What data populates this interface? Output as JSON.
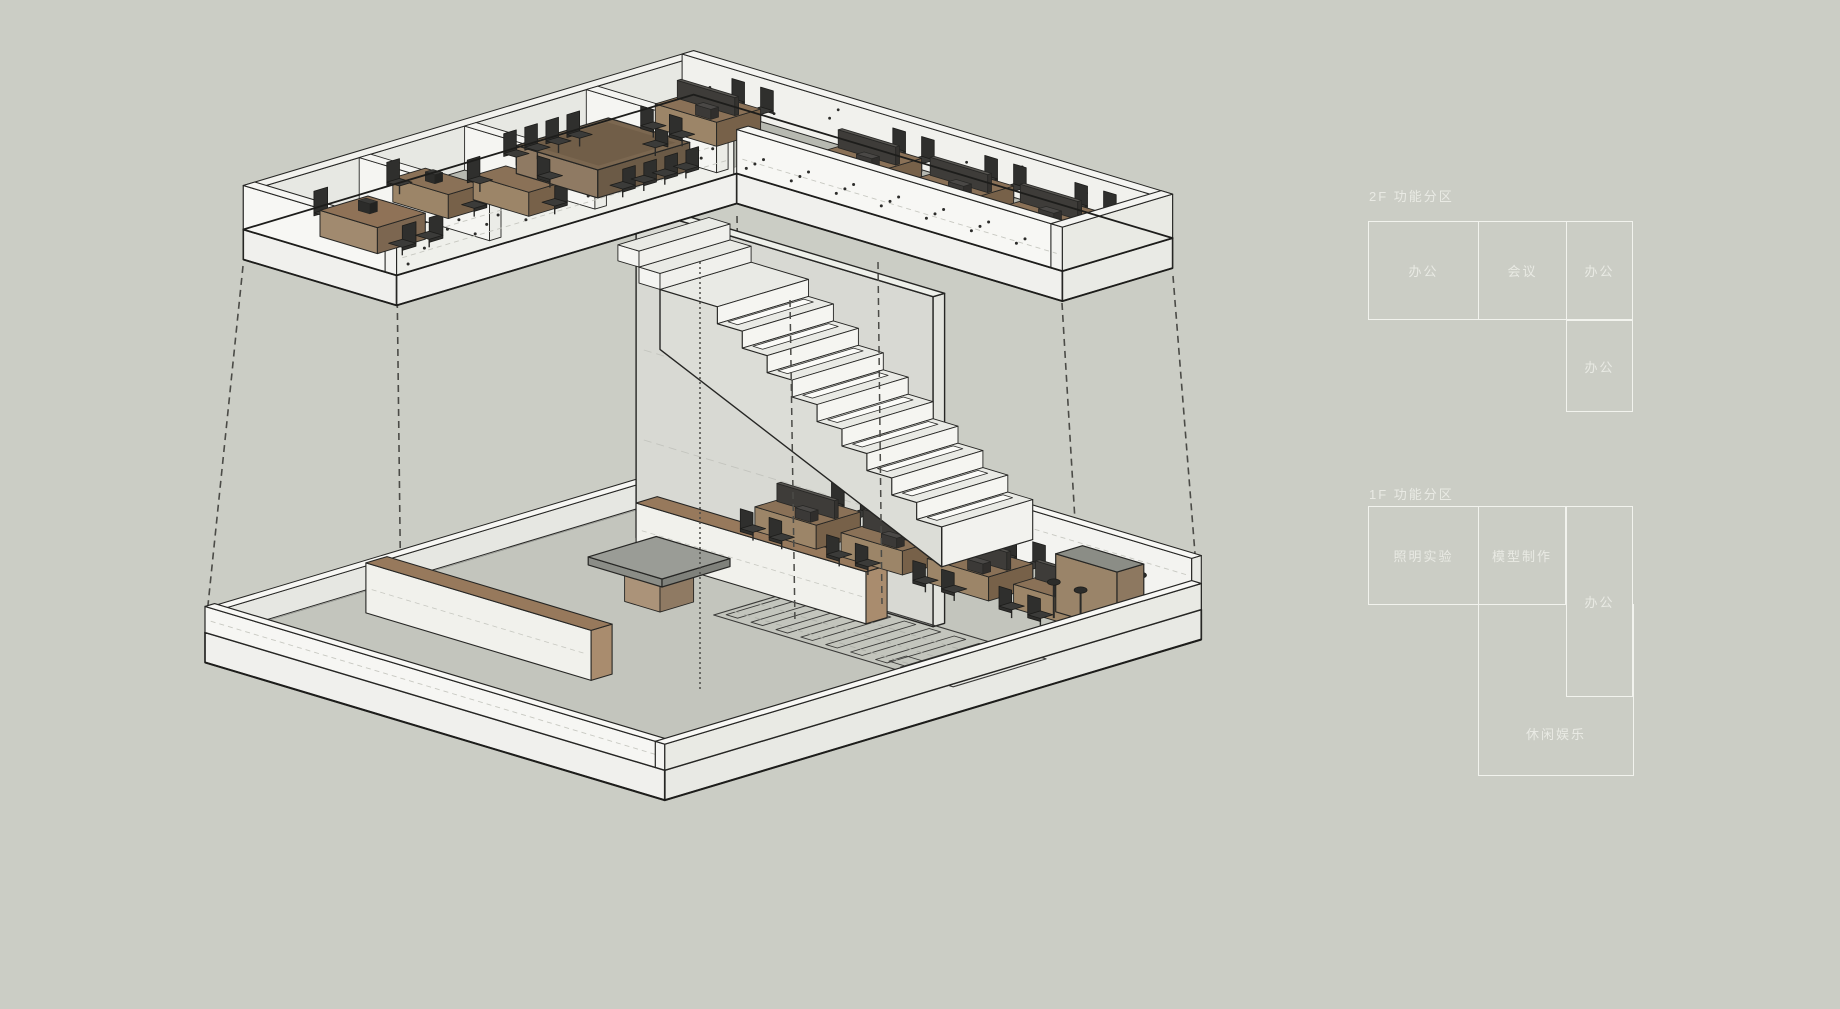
{
  "palette": {
    "bg": "#cbcdc5",
    "line": "#262624",
    "wall": "#f6f6f3",
    "wallShade": "#eaebe6",
    "wallDark": "#dfe0da",
    "slab": "#f0f0ed",
    "floor2f": "#b7b9b1",
    "floor1f": "#c3c5bd",
    "tallWall": "#d8d9d3",
    "stairSide": "#dcddd7",
    "tread": "#e9eae5",
    "riser": "#f5f5f1",
    "brownTop": "#91775c",
    "brownFace": "#a98c6e",
    "brownDark": "#7b6750",
    "grayTop": "#9a9c96",
    "chairDark": "#2f2f2d",
    "chairSeat": "#3b3b39",
    "dash": "#4b4b47",
    "lightDash": "#c7c8c1",
    "text": "#e9eae4",
    "cellBorder": "#f2f3ee"
  },
  "legend_2f": {
    "title": "2F 功能分区",
    "cells": [
      {
        "label": "办公"
      },
      {
        "label": "会议"
      },
      {
        "label": "办公"
      },
      {
        "label": "办公"
      }
    ]
  },
  "legend_1f": {
    "title": "1F 功能分区",
    "cells": [
      {
        "label": "照明实验"
      },
      {
        "label": "模型制作"
      },
      {
        "label": "办公"
      },
      {
        "label": "休闲娱乐"
      }
    ]
  }
}
